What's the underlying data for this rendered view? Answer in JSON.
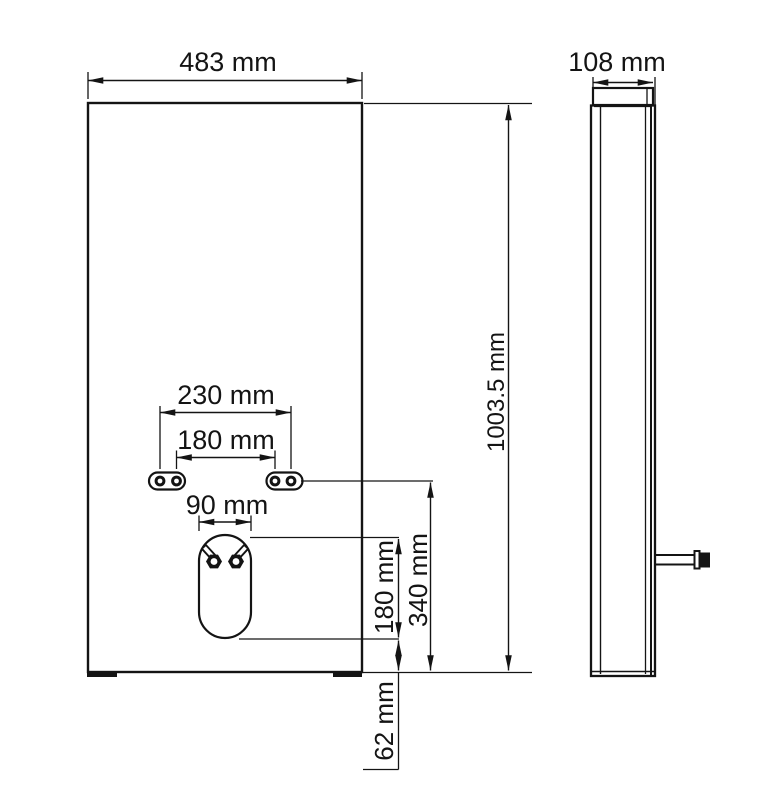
{
  "front_view": {
    "overall_width_label": "483 mm",
    "overall_height_label": "1003.5 mm",
    "anchor_spacing_outer_label": "230 mm",
    "anchor_spacing_inner_label": "180 mm",
    "opening_width_label": "90 mm",
    "opening_height_label": "180 mm",
    "anchor_to_bottom_label": "340 mm",
    "opening_to_bottom_label": "62 mm"
  },
  "side_view": {
    "depth_label": "108 mm"
  }
}
